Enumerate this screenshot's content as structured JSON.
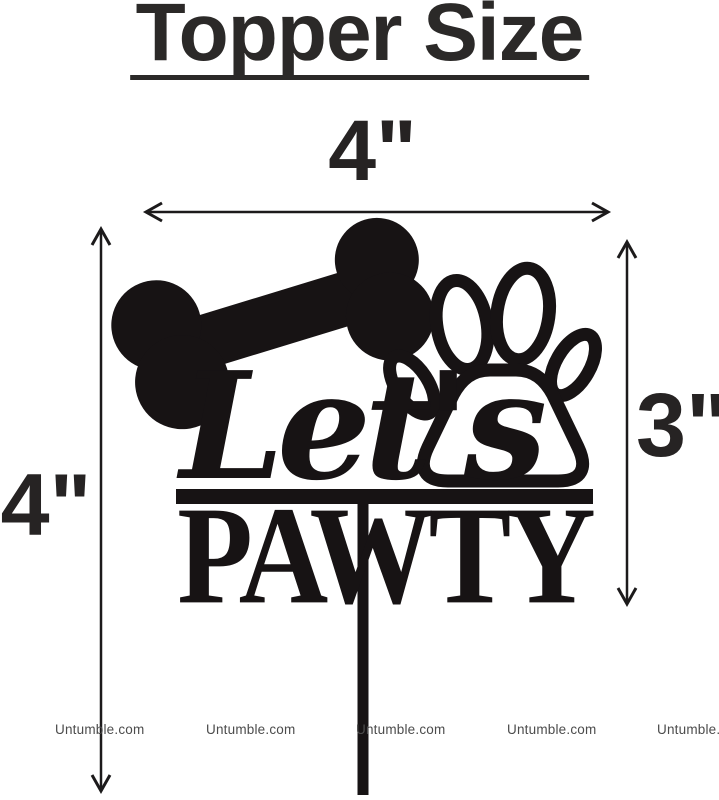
{
  "page": {
    "title": "Topper Size",
    "background_color": "#ffffff",
    "ink_color": "#1d1a1b",
    "title_color": "#2b2928",
    "watermark_color": "#4c4c4c"
  },
  "dimensions": {
    "top_width_label": "4\"",
    "left_height_label": "4\"",
    "right_height_label": "3\""
  },
  "topper": {
    "script_word": "Let's",
    "block_word": "PAWTY",
    "icons": [
      "bone-icon",
      "paw-icon",
      "stick"
    ]
  },
  "watermarks": [
    "Untumble.com",
    "Untumble.com",
    "Untumble.com",
    "Untumble.com",
    "Untumble.com"
  ]
}
